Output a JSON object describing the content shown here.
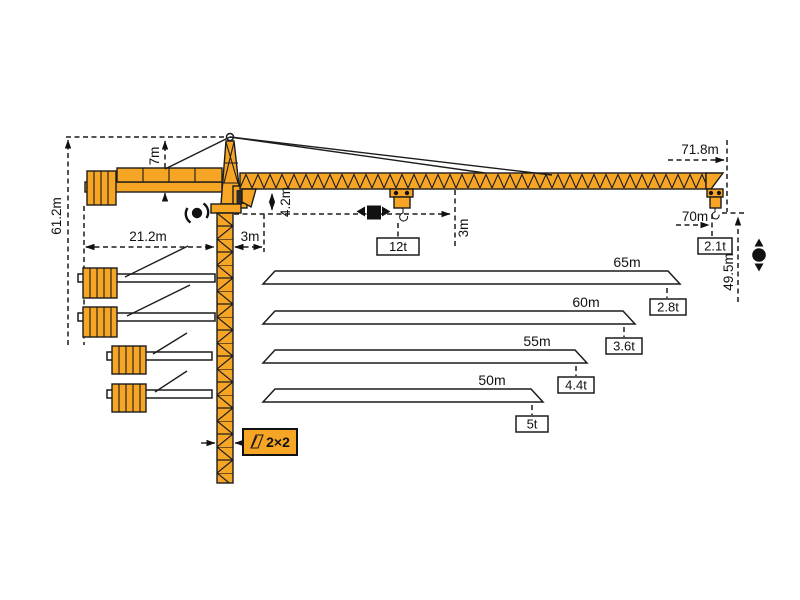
{
  "diagram": {
    "type": "tower-crane-load-diagram",
    "colors": {
      "crane": "#F6A524",
      "outline": "#1C1C1C",
      "background": "#FFFFFF"
    },
    "crane": {
      "total_height_label": "61.2m",
      "apex_height_label": "7m",
      "counterjib_length_label": "21.2m",
      "root_offset_label": "3m",
      "jib_underside_drop_label": "4.2m",
      "hook_approach_label": "3m",
      "max_capacity_label": "12t",
      "jib_length_label": "71.8m",
      "max_radius_label": "70m",
      "tip_capacity_label": "2.1t",
      "hook_height_label": "49.5m",
      "mast_section_label": "2×2"
    },
    "jib_options": [
      {
        "length": "65m",
        "tip_capacity": "2.8t"
      },
      {
        "length": "60m",
        "tip_capacity": "3.6t"
      },
      {
        "length": "55m",
        "tip_capacity": "4.4t"
      },
      {
        "length": "50m",
        "tip_capacity": "5t"
      }
    ],
    "icons": {
      "slewing": "rotation-arrows-around-dot",
      "trolley_travel": "left-right-arrows-square",
      "hoist": "up-down-arrows-dot",
      "mast_section": "mast-cross-section"
    }
  }
}
